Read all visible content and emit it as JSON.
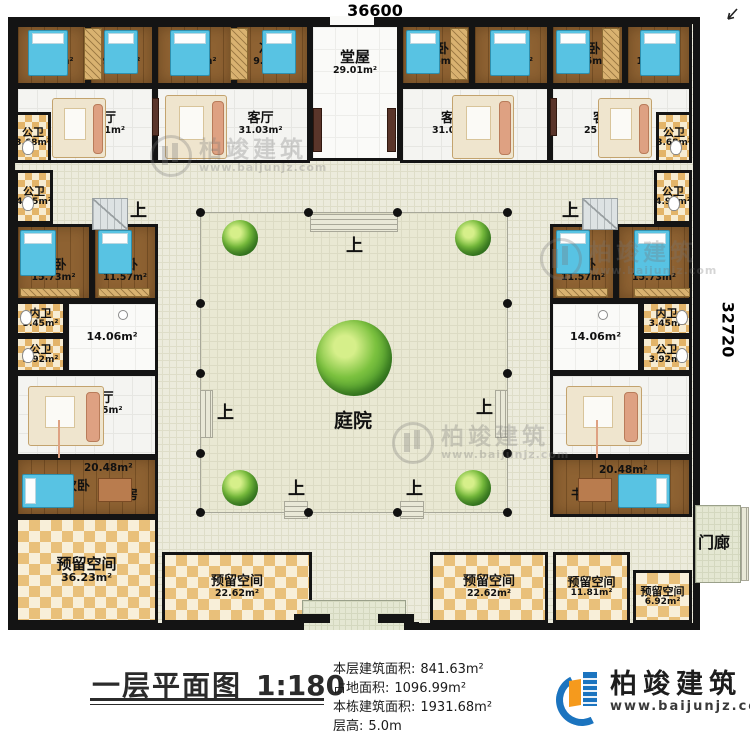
{
  "dimensions": {
    "top": "36600",
    "right": "32720"
  },
  "labels": {
    "up": "上"
  },
  "rooms": {
    "bed_tl_1": {
      "name": "次卧",
      "area": "11.13m²"
    },
    "bed_tl_2": {
      "name": "次卧",
      "area": "9.35m²"
    },
    "bed_tl_3": {
      "name": "次卧",
      "area": "12.31m²"
    },
    "bed_tl_4": {
      "name": "次卧",
      "area": "9.96m²"
    },
    "hall_main": {
      "name": "堂屋",
      "area": "29.01m²"
    },
    "bed_tr_1": {
      "name": "次卧",
      "area": "9.06m²"
    },
    "bed_tr_2": {
      "name": "次卧",
      "area": "12.31m²"
    },
    "bed_tr_3": {
      "name": "次卧",
      "area": "9.35m²"
    },
    "bed_tr_4": {
      "name": "次卧",
      "area": "11.13m²"
    },
    "bath_tl": {
      "name": "公卫",
      "area": "3.68m²"
    },
    "living_tl_1": {
      "name": "客厅",
      "area": "25.11m²"
    },
    "living_tl_2": {
      "name": "客厅",
      "area": "31.03m²"
    },
    "living_tr_1": {
      "name": "客厅",
      "area": "31.03m²"
    },
    "living_tr_2": {
      "name": "客厅",
      "area": "25.11m²"
    },
    "bath_tr": {
      "name": "公卫",
      "area": "3.68m²"
    },
    "bath_l1": {
      "name": "公卫",
      "area": "4.95m²"
    },
    "master_l": {
      "name": "主卧",
      "area": "15.73m²"
    },
    "bed_l": {
      "name": "次卧",
      "area": "11.57m²"
    },
    "ensuite_l": {
      "name": "内卫",
      "area": "3.45m²"
    },
    "bath_l2": {
      "name": "公卫",
      "area": "3.92m²"
    },
    "hall_l": {
      "area": "14.06m²"
    },
    "living_l": {
      "name": "客厅",
      "area": "28.35m²"
    },
    "suite_l": {
      "area": "20.48m²",
      "bed": "次卧",
      "study": "书房"
    },
    "reserved_l": {
      "name": "预留空间",
      "area": "36.23m²"
    },
    "bath_r1": {
      "name": "公卫",
      "area": "4.95m²"
    },
    "bed_r": {
      "name": "次卧",
      "area": "11.57m²"
    },
    "master_r": {
      "name": "主卧",
      "area": "15.73m²"
    },
    "ensuite_r": {
      "name": "内卫",
      "area": "3.45m²"
    },
    "bath_r2": {
      "name": "公卫",
      "area": "3.92m²"
    },
    "hall_r": {
      "area": "14.06m²"
    },
    "living_r": {
      "name": "客厅",
      "area": "28.35m²"
    },
    "suite_r": {
      "area": "20.48m²",
      "bed": "次卧",
      "study": "书房"
    },
    "reserved_b1": {
      "name": "预留空间",
      "area": "22.62m²"
    },
    "reserved_b2": {
      "name": "预留空间",
      "area": "22.62m²"
    },
    "reserved_b3": {
      "name": "预留空间",
      "area": "11.81m²"
    },
    "reserved_b4": {
      "name": "预留空间",
      "area": "6.92m²"
    },
    "courtyard": {
      "name": "庭院"
    },
    "porch_b": {
      "name": "门廊"
    },
    "porch_r": {
      "name": "门廊"
    }
  },
  "titleblock": {
    "title": "一层平面图",
    "scale": "1:180",
    "stats": [
      {
        "label": "本层建筑面积:",
        "value": "841.63m²"
      },
      {
        "label": "占地面积:",
        "value": "1096.99m²"
      },
      {
        "label": "本栋建筑面积:",
        "value": "1931.68m²"
      },
      {
        "label": "层高:",
        "value": "5.0m"
      }
    ]
  },
  "brand": {
    "name": "柏竣建筑",
    "url": "www.baijunjz.com"
  },
  "watermark": {
    "name": "柏竣建筑",
    "url": "www.baijunjz.com"
  },
  "colors": {
    "wall": "#141414",
    "wood_floor": "#8e6232",
    "bed_blue": "#58c3e3",
    "bath_tile": "#e3b469",
    "reserved_tile": "#e9c07a",
    "walkway": "#ecebdc",
    "brand_blue": "#1b74bf",
    "brand_orange": "#f59a1d"
  }
}
